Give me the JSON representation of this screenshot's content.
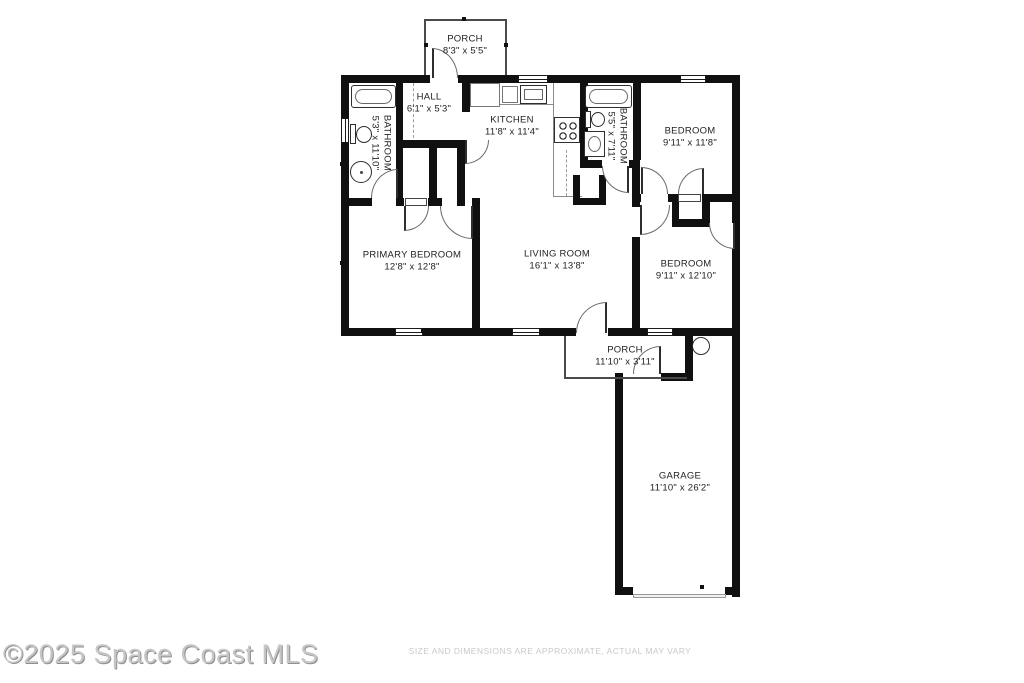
{
  "floorplan": {
    "rooms": [
      {
        "id": "porch-top",
        "name": "PORCH",
        "dims": "8'3\" x 5'5\""
      },
      {
        "id": "hall",
        "name": "HALL",
        "dims": "6'1\" x 5'3\""
      },
      {
        "id": "kitchen",
        "name": "KITCHEN",
        "dims": "11'8\" x 11'4\""
      },
      {
        "id": "bathroom-left",
        "name": "BATHROOM",
        "dims": "5'3\" x 11'10\""
      },
      {
        "id": "bathroom-middle",
        "name": "BATHROOM",
        "dims": "5'5\" x 7'11\""
      },
      {
        "id": "bedroom-top-right",
        "name": "BEDROOM",
        "dims": "9'11\" x 11'8\""
      },
      {
        "id": "primary-bedroom",
        "name": "PRIMARY BEDROOM",
        "dims": "12'8\" x 12'8\""
      },
      {
        "id": "living-room",
        "name": "LIVING ROOM",
        "dims": "16'1\" x 13'8\""
      },
      {
        "id": "bedroom-bottom-right",
        "name": "BEDROOM",
        "dims": "9'11\" x 12'10\""
      },
      {
        "id": "porch-bottom",
        "name": "PORCH",
        "dims": "11'10\" x 3'11\""
      },
      {
        "id": "garage",
        "name": "GARAGE",
        "dims": "11'10\" x 26'2\""
      }
    ],
    "colors": {
      "wall": "#101010",
      "watermark": "#c6c6c6",
      "disclaimer": "#c9c9c9"
    }
  },
  "footer": {
    "watermark": "©2025 Space Coast MLS",
    "disclaimer": "SIZE AND DIMENSIONS ARE APPROXIMATE, ACTUAL MAY VARY"
  }
}
